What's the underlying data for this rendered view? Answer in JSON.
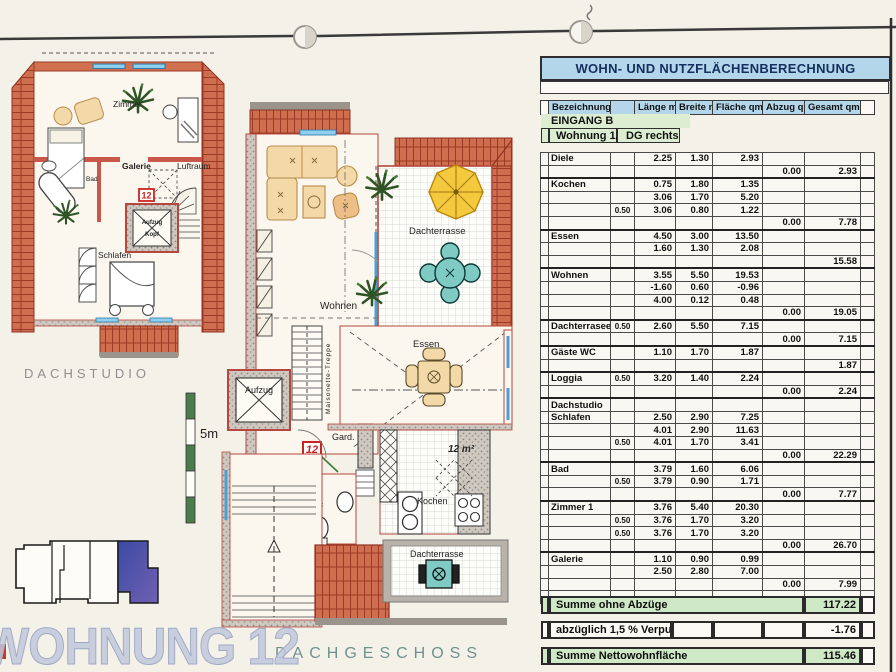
{
  "table": {
    "title": "WOHN- UND NUTZFLÄCHENBERECHNUNG",
    "columns": [
      "Bezeichnung",
      "Länge m",
      "Breite m",
      "Fläche qm",
      "Abzug qm",
      "Gesamt qm"
    ],
    "entrance": "EINGANG B",
    "unit": "Wohnung 12",
    "unit_location": "DG rechts",
    "rows": [
      {
        "n": "Diele",
        "l": "2.25",
        "b": "1.30",
        "fl": "2.93"
      },
      {
        "a": "0.00",
        "g": "2.93"
      },
      {
        "n": "Kochen",
        "l": "0.75",
        "b": "1.80",
        "fl": "1.35"
      },
      {
        "l": "3.06",
        "b": "1.70",
        "fl": "5.20"
      },
      {
        "f": "0.50",
        "l": "3.06",
        "b": "0.80",
        "fl": "1.22"
      },
      {
        "a": "0.00",
        "g": "7.78"
      },
      {
        "n": "Essen",
        "l": "4.50",
        "b": "3.00",
        "fl": "13.50"
      },
      {
        "l": "1.60",
        "b": "1.30",
        "fl": "2.08"
      },
      {
        "g": "15.58"
      },
      {
        "n": "Wohnen",
        "l": "3.55",
        "b": "5.50",
        "fl": "19.53"
      },
      {
        "l": "-1.60",
        "b": "0.60",
        "fl": "-0.96"
      },
      {
        "l": "4.00",
        "b": "0.12",
        "fl": "0.48"
      },
      {
        "a": "0.00",
        "g": "19.05"
      },
      {
        "n": "Dachterrasee",
        "f": "0.50",
        "l": "2.60",
        "b": "5.50",
        "fl": "7.15"
      },
      {
        "a": "0.00",
        "g": "7.15"
      },
      {
        "n": "Gäste WC",
        "l": "1.10",
        "b": "1.70",
        "fl": "1.87"
      },
      {
        "g": "1.87"
      },
      {
        "n": "Loggia",
        "f": "0.50",
        "l": "3.20",
        "b": "1.40",
        "fl": "2.24"
      },
      {
        "a": "0.00",
        "g": "2.24"
      },
      {
        "n": "Dachstudio"
      },
      {
        "n": "Schlafen",
        "l": "2.50",
        "b": "2.90",
        "fl": "7.25"
      },
      {
        "l": "4.01",
        "b": "2.90",
        "fl": "11.63"
      },
      {
        "f": "0.50",
        "l": "4.01",
        "b": "1.70",
        "fl": "3.41"
      },
      {
        "a": "0.00",
        "g": "22.29"
      },
      {
        "n": "Bad",
        "l": "3.79",
        "b": "1.60",
        "fl": "6.06"
      },
      {
        "f": "0.50",
        "l": "3.79",
        "b": "0.90",
        "fl": "1.71"
      },
      {
        "a": "0.00",
        "g": "7.77"
      },
      {
        "n": "Zimmer 1",
        "l": "3.76",
        "b": "5.40",
        "fl": "20.30"
      },
      {
        "f": "0.50",
        "l": "3.76",
        "b": "1.70",
        "fl": "3.20"
      },
      {
        "f": "0.50",
        "l": "3.76",
        "b": "1.70",
        "fl": "3.20"
      },
      {
        "a": "0.00",
        "g": "26.70"
      },
      {
        "n": "Galerie",
        "l": "1.10",
        "b": "0.90",
        "fl": "0.99"
      },
      {
        "l": "2.50",
        "b": "2.80",
        "fl": "7.00"
      },
      {
        "a": "0.00",
        "g": "7.99"
      },
      {}
    ],
    "summary": [
      {
        "label": "Summe ohne Abzüge",
        "value": "117.22"
      },
      {
        "label": "abzüglich 1,5 % Verputz",
        "value": "-1.76"
      },
      {
        "label": "Summe Nettowohnfläche",
        "value": "115.46"
      }
    ]
  },
  "plans": {
    "scale_label": "5m",
    "keyplan_title": "WOHNUNG 12",
    "dachstudio": {
      "caption": "DACHSTUDIO",
      "unit_marker": "12",
      "rooms": {
        "zimmer": "Zimmer",
        "bad": "Bad",
        "galerie": "Galerie",
        "luftraum": "Luftraum",
        "schlafen": "Schlafen",
        "aufzug": "Aufzug",
        "kopf": "Kopf"
      }
    },
    "dachgeschoss": {
      "caption": "DACHGESCHOSS",
      "unit_marker": "12",
      "area_note": "12 m²",
      "rooms": {
        "wohnen": "Wohnen",
        "dachterrasse_oben": "Dachterrasse",
        "essen": "Essen",
        "aufzug": "Aufzug",
        "treppe": "Maisonette-Treppe",
        "gard": "Gard.",
        "wc": "Wc",
        "kochen": "Kochen",
        "dachterrasse_unten": "Dachterrasse"
      }
    }
  }
}
